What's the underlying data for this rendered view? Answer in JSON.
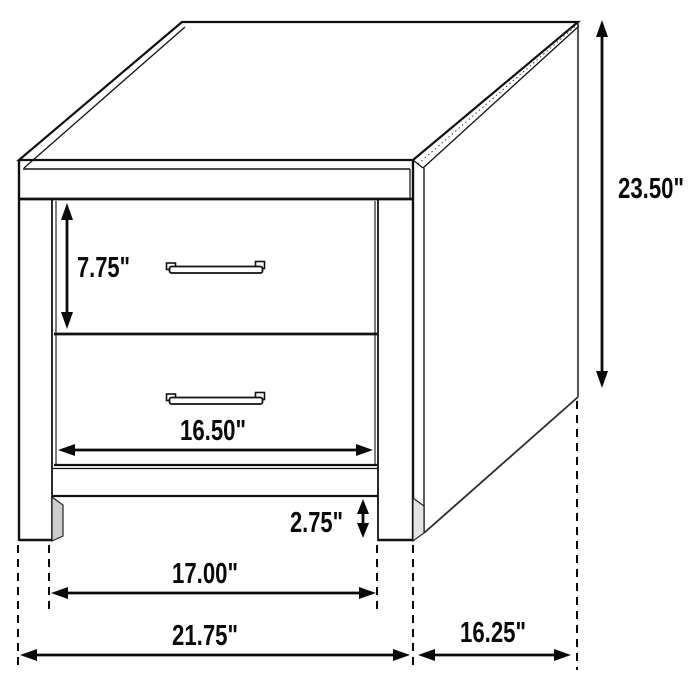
{
  "diagram": {
    "kind": "furniture-dimension-drawing",
    "colors": {
      "line": "#111111",
      "background": "#ffffff",
      "shading": "#cdcdcd"
    },
    "dimensions": {
      "height": "23.50\"",
      "drawer_face_height": "7.75\"",
      "drawer_opening_width": "16.50\"",
      "floor_clearance": "2.75\"",
      "between_legs_width": "17.00\"",
      "overall_width": "21.75\"",
      "depth": "16.25\""
    }
  }
}
